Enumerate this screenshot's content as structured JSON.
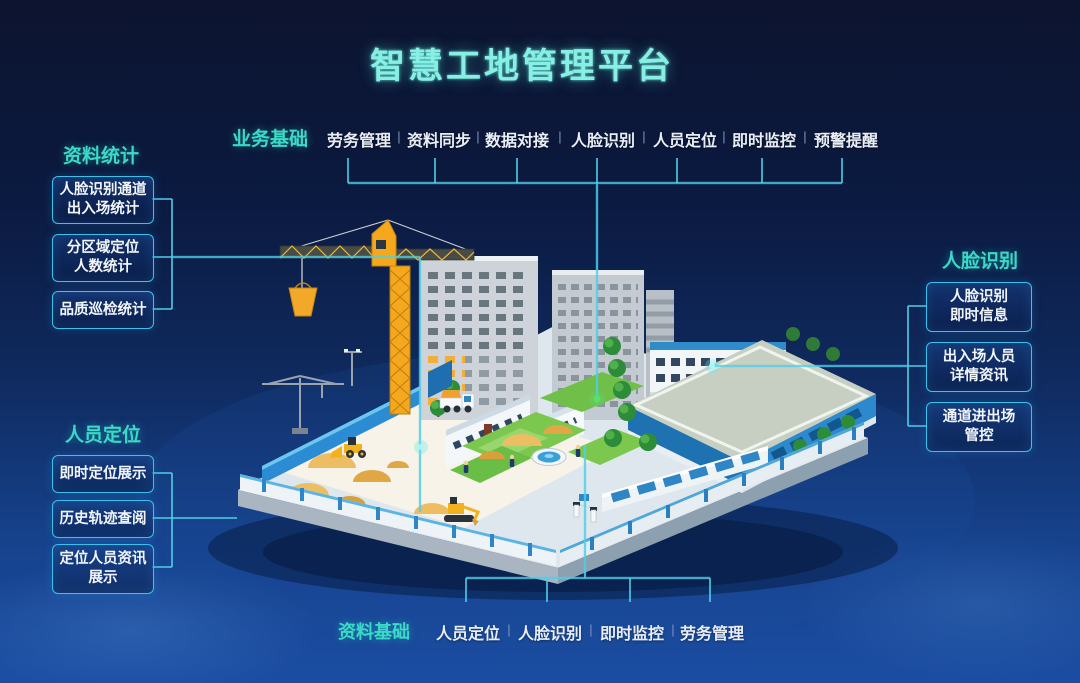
{
  "title": "智慧工地管理平台",
  "colors": {
    "background_top": "#0c142f",
    "background_bottom": "#1b4da3",
    "heading_teal": "#3bd9c7",
    "title_cyan": "#87efe3",
    "box_border": "#3cc2ea",
    "connector_line": "#4ecfe8",
    "glow_dot_green": "#58e06e",
    "glow_dot_cyan": "#5ae8f0"
  },
  "top_menu": {
    "heading": "业务基础",
    "separator": "|",
    "items": [
      "劳务管理",
      "资料同步",
      "数据对接",
      "人脸识别",
      "人员定位",
      "即时监控",
      "预警提醒"
    ]
  },
  "bottom_menu": {
    "heading": "资料基础",
    "separator": "|",
    "items": [
      "人员定位",
      "人脸识别",
      "即时监控",
      "劳务管理"
    ]
  },
  "left_top_group": {
    "heading": "资料统计",
    "boxes": [
      {
        "lines": [
          "人脸识别通道",
          "出入场统计"
        ]
      },
      {
        "lines": [
          "分区域定位",
          "人数统计"
        ]
      },
      {
        "lines": [
          "品质巡检统计"
        ]
      }
    ]
  },
  "left_bottom_group": {
    "heading": "人员定位",
    "boxes": [
      {
        "lines": [
          "即时定位展示"
        ]
      },
      {
        "lines": [
          "历史轨迹查阅"
        ]
      },
      {
        "lines": [
          "定位人员资讯",
          "展示"
        ]
      }
    ]
  },
  "right_group": {
    "heading": "人脸识别",
    "boxes": [
      {
        "lines": [
          "人脸识别",
          "即时信息"
        ]
      },
      {
        "lines": [
          "出入场人员",
          "详情资讯"
        ]
      },
      {
        "lines": [
          "通道进出场",
          "管控"
        ]
      }
    ]
  },
  "illustration": {
    "description": "isometric smart construction site",
    "elements": [
      "tower-crane",
      "crane-bucket",
      "high-rise-buildings",
      "construction-yard",
      "sand-piles",
      "dump-truck",
      "wheel-loader",
      "excavator",
      "workers",
      "mobile-crane",
      "office-buildings",
      "dormitory-building",
      "warehouse-building",
      "courtyard-lawn",
      "fountain",
      "trees",
      "hedges",
      "blue-hoarding-wall",
      "perimeter-fence",
      "site-gate"
    ]
  }
}
